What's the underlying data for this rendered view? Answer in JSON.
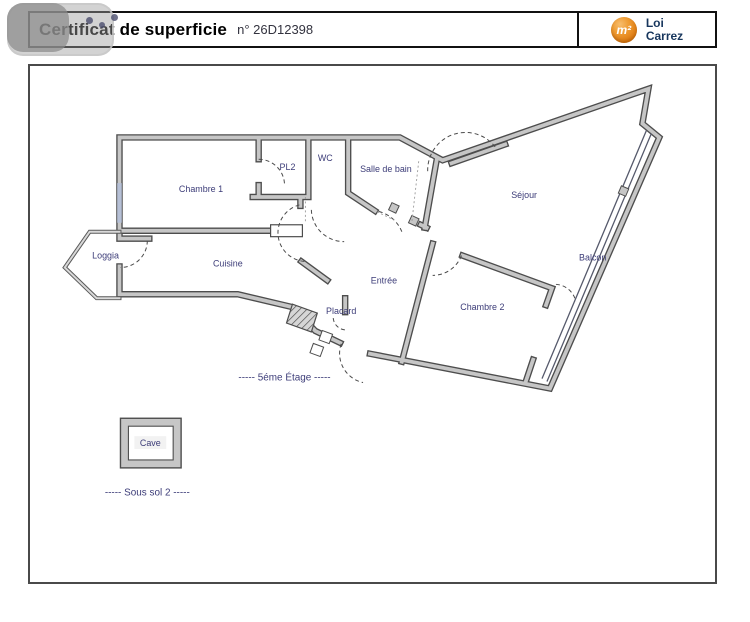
{
  "header": {
    "title": "Certificat de superficie",
    "doc_number": "n° 26D12398",
    "logo": {
      "symbol": "m²",
      "line1": "Loi",
      "line2": "Carrez",
      "circle_color": "#de7a10",
      "text_color": "#17365d"
    }
  },
  "plan": {
    "rooms": [
      {
        "name": "Chambre 1"
      },
      {
        "name": "PL2"
      },
      {
        "name": "WC"
      },
      {
        "name": "Salle de bain"
      },
      {
        "name": "Séjour"
      },
      {
        "name": "Balcon"
      },
      {
        "name": "Chambre 2"
      },
      {
        "name": "Entrée"
      },
      {
        "name": "Cuisine"
      },
      {
        "name": "Loggia"
      },
      {
        "name": "Placard"
      }
    ],
    "floor_label": "-----  5éme Étage  -----",
    "basement": {
      "room": "Cave",
      "label": "-----  Sous sol 2  -----"
    },
    "colors": {
      "wall_fill": "#c6c6c6",
      "wall_outline": "#4d4d4d",
      "label_color": "#3c3c78",
      "window": "#b6c0d6"
    }
  }
}
